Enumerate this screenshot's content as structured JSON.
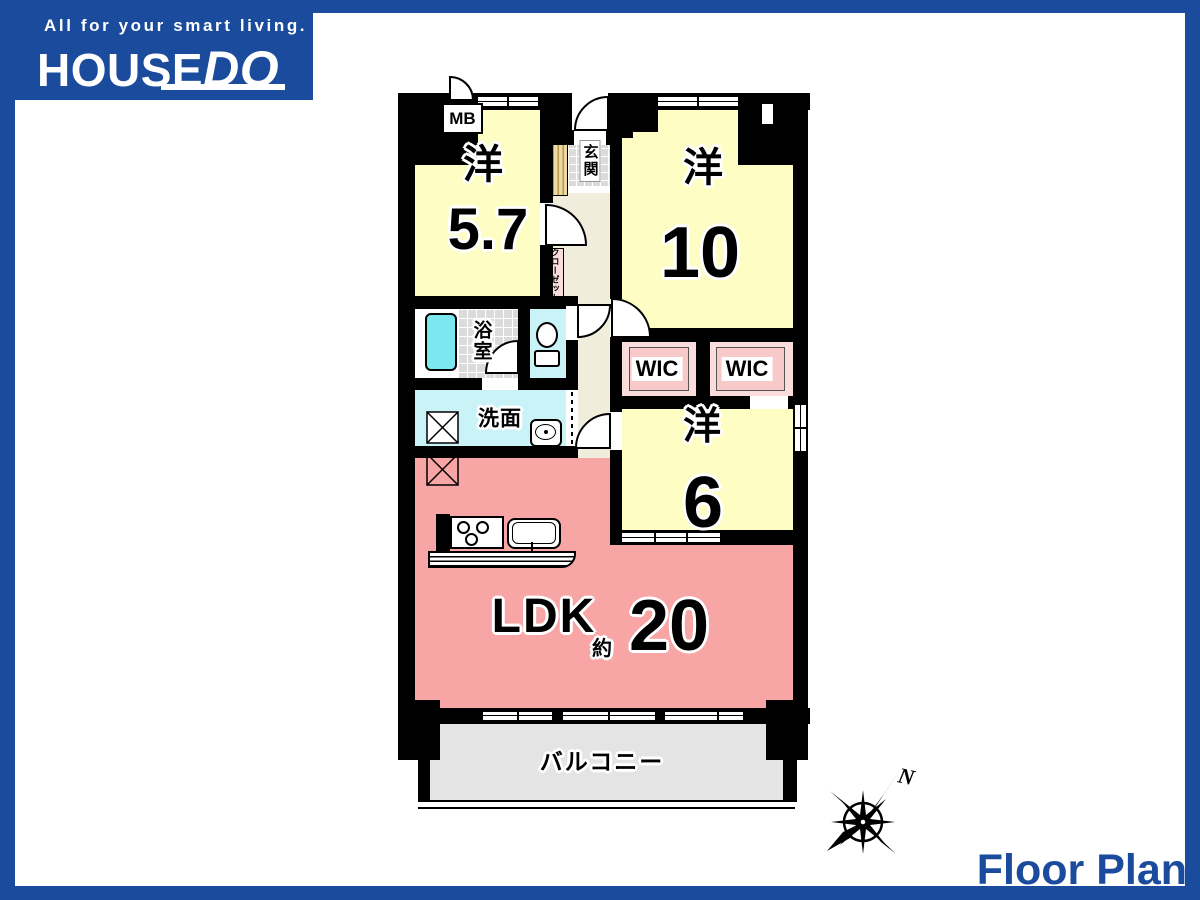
{
  "logo": {
    "tagline": "All for your smart living.",
    "brand_main": "HOUSE",
    "brand_accent": "DO"
  },
  "palette": {
    "accent_blue": "#1A4B9C",
    "room_yellow": "#FDFDC4",
    "ldk_pink": "#F7A5A5",
    "wic_pink": "#F8C9C9",
    "corridor_beige": "#F1EDDC",
    "wet_cyan": "#C9F3F6",
    "tub_cyan": "#7DE7F0",
    "balcony_gray": "#E4E4E4"
  },
  "plan": {
    "mb": "MB",
    "room_5_7_kanji": "洋",
    "room_5_7_size": "5.7",
    "genkan": "玄関",
    "closet": "クローゼット",
    "room_10_kanji": "洋",
    "room_10_size": "10",
    "bath": "浴室",
    "washroom": "洗面",
    "wic_left": "WIC",
    "wic_right": "WIC",
    "room_6_kanji": "洋",
    "room_6_size": "6",
    "ldk": "LDK",
    "ldk_approx": "約",
    "ldk_size": "20",
    "balcony": "バルコニー",
    "compass_north": "N"
  },
  "footer": {
    "title": "Floor Plan"
  }
}
